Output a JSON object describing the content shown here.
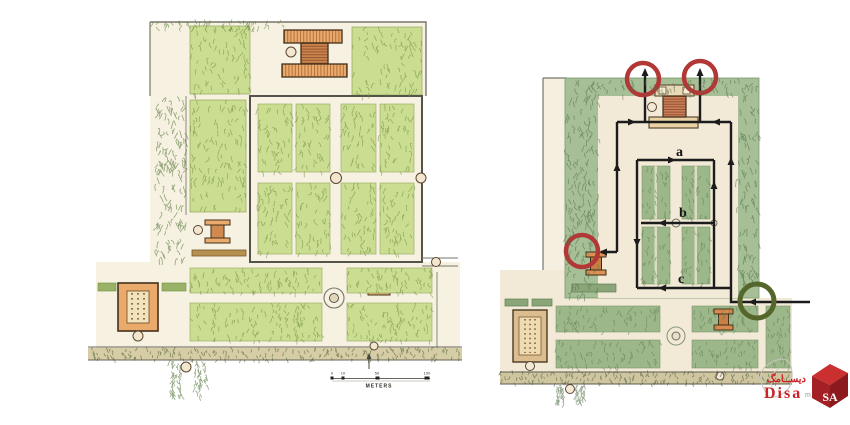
{
  "colors": {
    "route": "#1c1c1c",
    "exit_ring": "#b23737",
    "entrance_ring": "#55662b",
    "brand_red": "#cb2128"
  },
  "left_plan": {
    "scale_bar": {
      "unit_label": "METERS",
      "ticks": [
        "0",
        "10",
        "50",
        "100"
      ]
    }
  },
  "right_plan": {
    "route_labels": {
      "a": "a",
      "b": "b",
      "c": "c"
    }
  },
  "watermark": {
    "brand_fa": "دیســامگ",
    "brand_en": "Disa",
    "brand_suffix": "mag",
    "cube_text": "SA"
  }
}
